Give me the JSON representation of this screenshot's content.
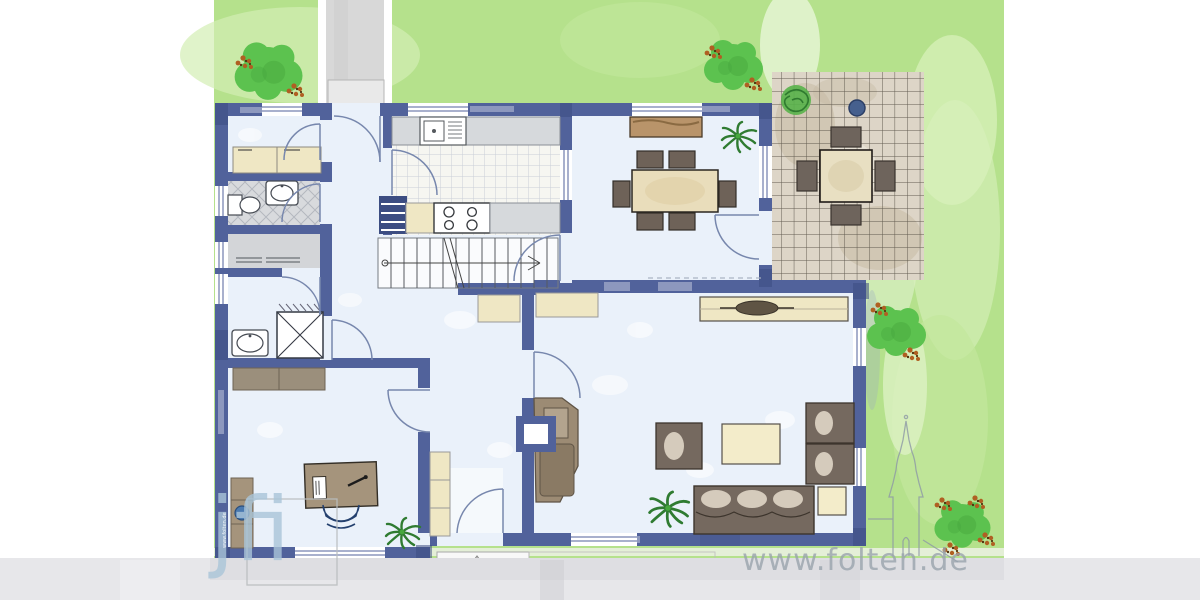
{
  "watermarks": {
    "site_url": "www.folten.de",
    "logo_text": "jfi",
    "left_wall_text": "www.folten.de"
  },
  "colors": {
    "wall": "#51629b",
    "wall-dark": "#3c4d82",
    "floor": "#eaf1fa",
    "lawn": "#b5e18c",
    "lawn-light": "#d3eeb4",
    "path-gray": "#d8d8d8",
    "bottom-strip": "#e7e7ea",
    "terrace-base": "#ddd5c7",
    "terrace-grid": "#4d463c",
    "tile-line": "#c9cfd8",
    "bath-floor": "#d8dadd",
    "wood": "#a5947c",
    "wood-dark": "#b9946a",
    "beige": "#efe7c4",
    "pale-yellow": "#f3ecca",
    "counter-gray": "#d6d9dc",
    "seat-dark": "#75695f",
    "cushion": "#d5cbbc",
    "tree-green": "#5cc24f",
    "tree-dark": "#47a83e",
    "berry-orange": "#b05f22",
    "berry-dark": "#53350f",
    "plant-dark": "#2f7b31",
    "chair-blue": "#3c5a8c",
    "stove-brown": "#9c8b74",
    "watermark-gray": "#99a2ac",
    "watermark-blue": "#a9c4d8",
    "door-arc": "#7787ad"
  },
  "plan": {
    "rooms": [
      "utility-room",
      "wc",
      "storage-room",
      "shower-bathroom",
      "office",
      "hallway",
      "kitchen",
      "staircase",
      "dining-room",
      "living-room",
      "entrance"
    ],
    "garden": [
      "lawn",
      "garden-path",
      "tiled-terrace",
      "patio-table-with-four-chairs",
      "berry-trees",
      "flowering-shrub",
      "potted-palms"
    ],
    "furniture": [
      "kitchen-counter-with-sink",
      "stove-four-burners",
      "staircase-steps",
      "dining-table-with-six-chairs",
      "dining-sideboard",
      "bathroom-sink",
      "toilet",
      "shower",
      "wardrobes",
      "desk-with-office-chair",
      "bookshelf",
      "tiled-stove-with-chimney",
      "armchairs",
      "coffee-table",
      "sofa-with-cushions",
      "side-table",
      "sideboard-with-lamp"
    ]
  }
}
